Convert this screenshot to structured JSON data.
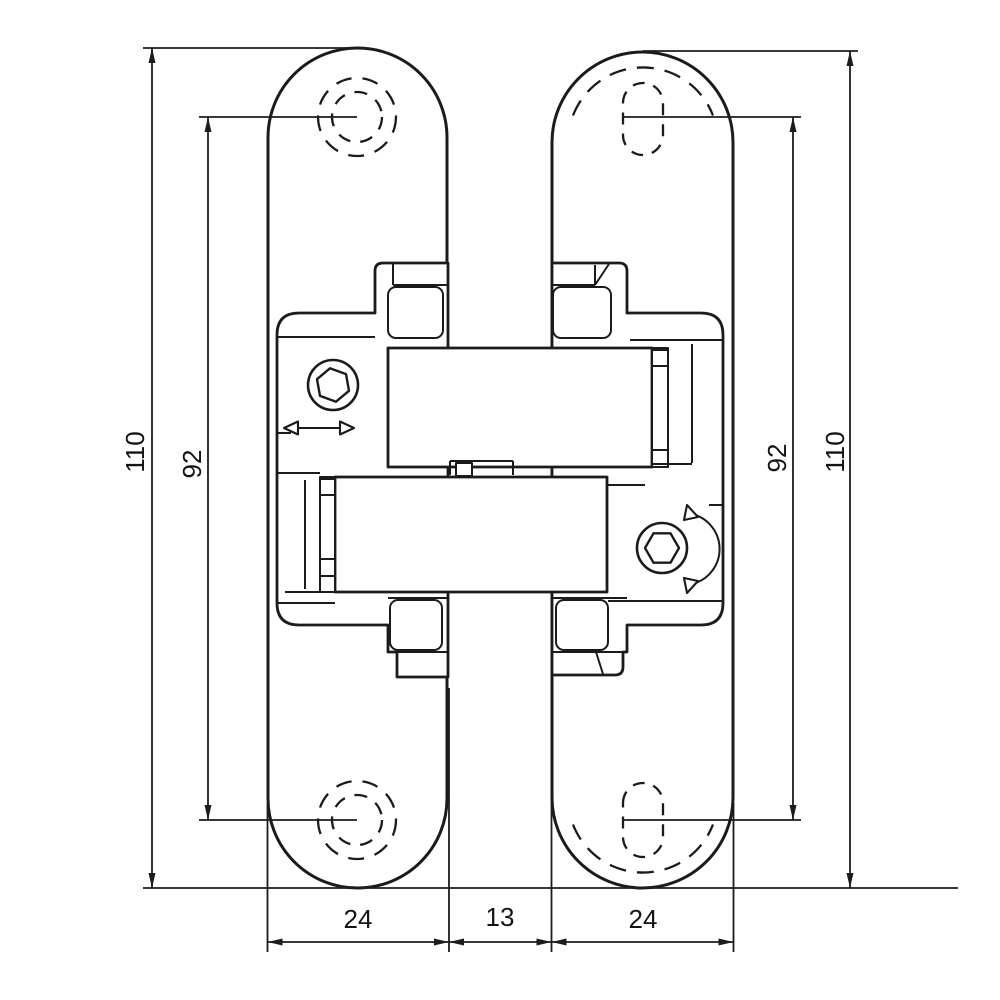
{
  "drawing": {
    "type": "technical-drawing",
    "subject": "concealed door hinge front elevation with mounting plates, adjustment screws and dimension lines",
    "line_color": "#1b1b1b",
    "background_color": "#ffffff",
    "dimensions": {
      "left_outer_height": "110",
      "left_hole_spacing": "92",
      "right_hole_spacing": "92",
      "right_outer_height": "110",
      "bottom_left_plate_width": "24",
      "bottom_gap_width": "13",
      "bottom_right_plate_width": "24"
    },
    "icons": [
      "hex-socket-screw-icon",
      "horizontal-double-arrow-icon",
      "rotation-double-arrow-icon",
      "dashed-screw-hole-icon",
      "dashed-slot-hole-icon"
    ]
  }
}
